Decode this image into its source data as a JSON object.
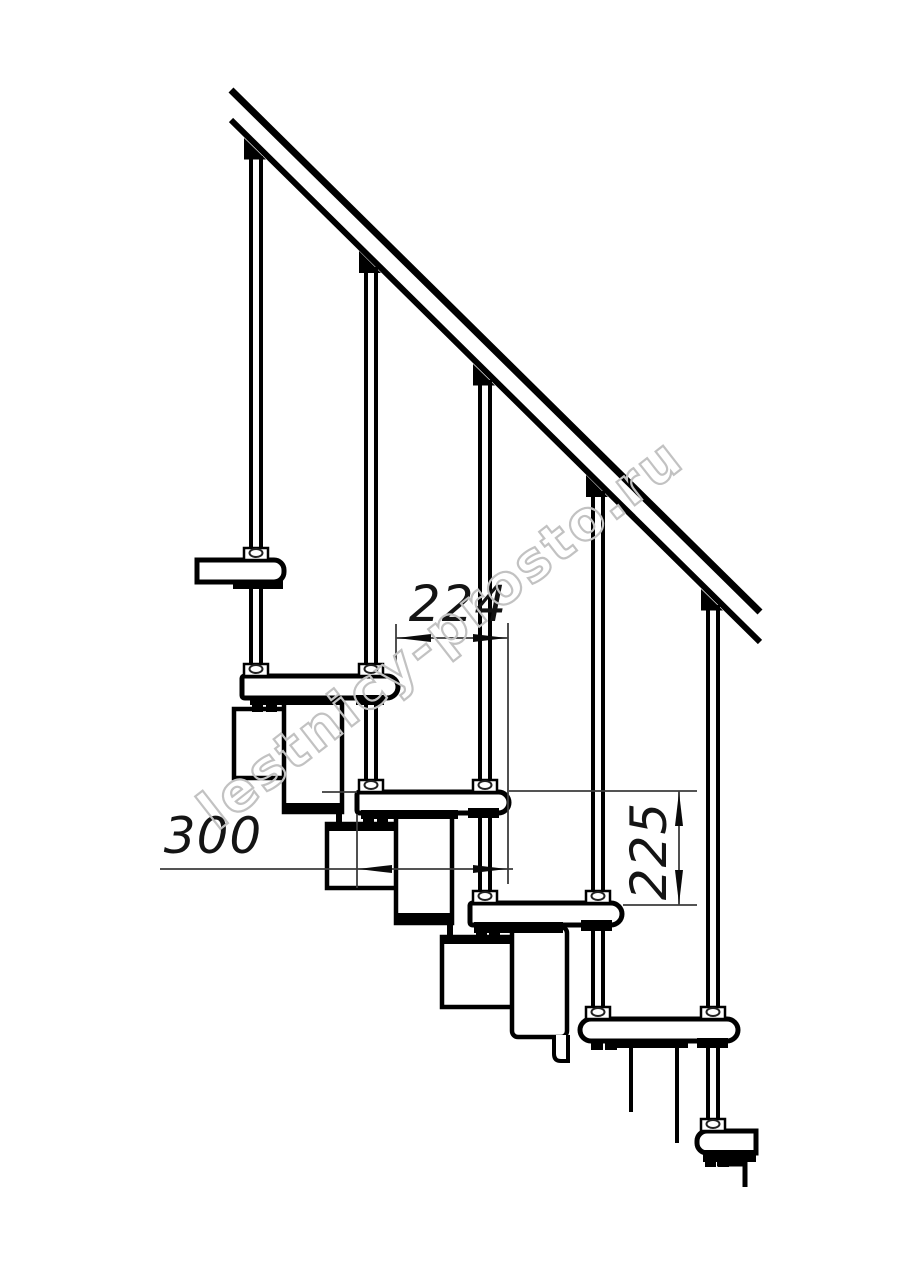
{
  "page": {
    "background": "#ffffff",
    "width": 914,
    "height": 1280
  },
  "drawing": {
    "kind": "technical side-elevation drawing of a modular staircase with handrail and balusters",
    "line_color": "#000000",
    "dimension_line_color": "#3c3c3c",
    "dimension_text_color": "#141414",
    "treads_count": 5,
    "balusters_count": 5,
    "dimensions": {
      "step_run": {
        "value": "224",
        "orientation": "horizontal"
      },
      "tread_depth": {
        "value": "300",
        "orientation": "horizontal"
      },
      "step_rise": {
        "value": "225",
        "orientation": "vertical"
      }
    },
    "watermark": {
      "text": "lestnicy-prosto.ru",
      "color": "#c2c2c2"
    }
  }
}
